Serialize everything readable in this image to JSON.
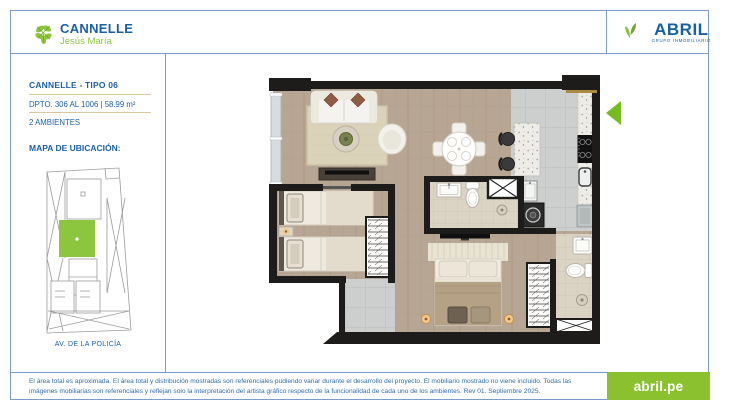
{
  "header": {
    "project": {
      "name": "CANNELLE",
      "location": "Jesús María"
    },
    "developer": {
      "name": "ABRIL",
      "tagline": "GRUPO INMOBILIARIO"
    }
  },
  "sidebar": {
    "unit_title": "CANNELLE - TIPO 06",
    "unit_info": "DPTO. 306 AL 1006 | 58.99 m²",
    "unit_rooms": "2 AMBIENTES",
    "map_heading": "MAPA DE UBICACIÓN:",
    "map_street": "AV. DE LA POLICÍA"
  },
  "footer": {
    "disclaimer": "El área total es aproximada. El área total y distribución mostradas son referenciales pudiendo variar durante el desarrollo del proyecto. El mobiliario mostrado no viene incluido. Todas las imágenes mobiliarias son referenciales y reflejan solo la interpretación del artista gráfico respecto de la funcionalidad de cada uno de los ambientes. Rev 01. Septiembre 2025.",
    "website": "abril.pe"
  },
  "colors": {
    "brand_blue": "#1b5fa8",
    "brand_green": "#8cc63f",
    "entry_arrow_green": "#76bc21",
    "divider_tan": "#d8c89b",
    "button_green": "#8bc02f",
    "wall_black": "#1d1c1a"
  }
}
